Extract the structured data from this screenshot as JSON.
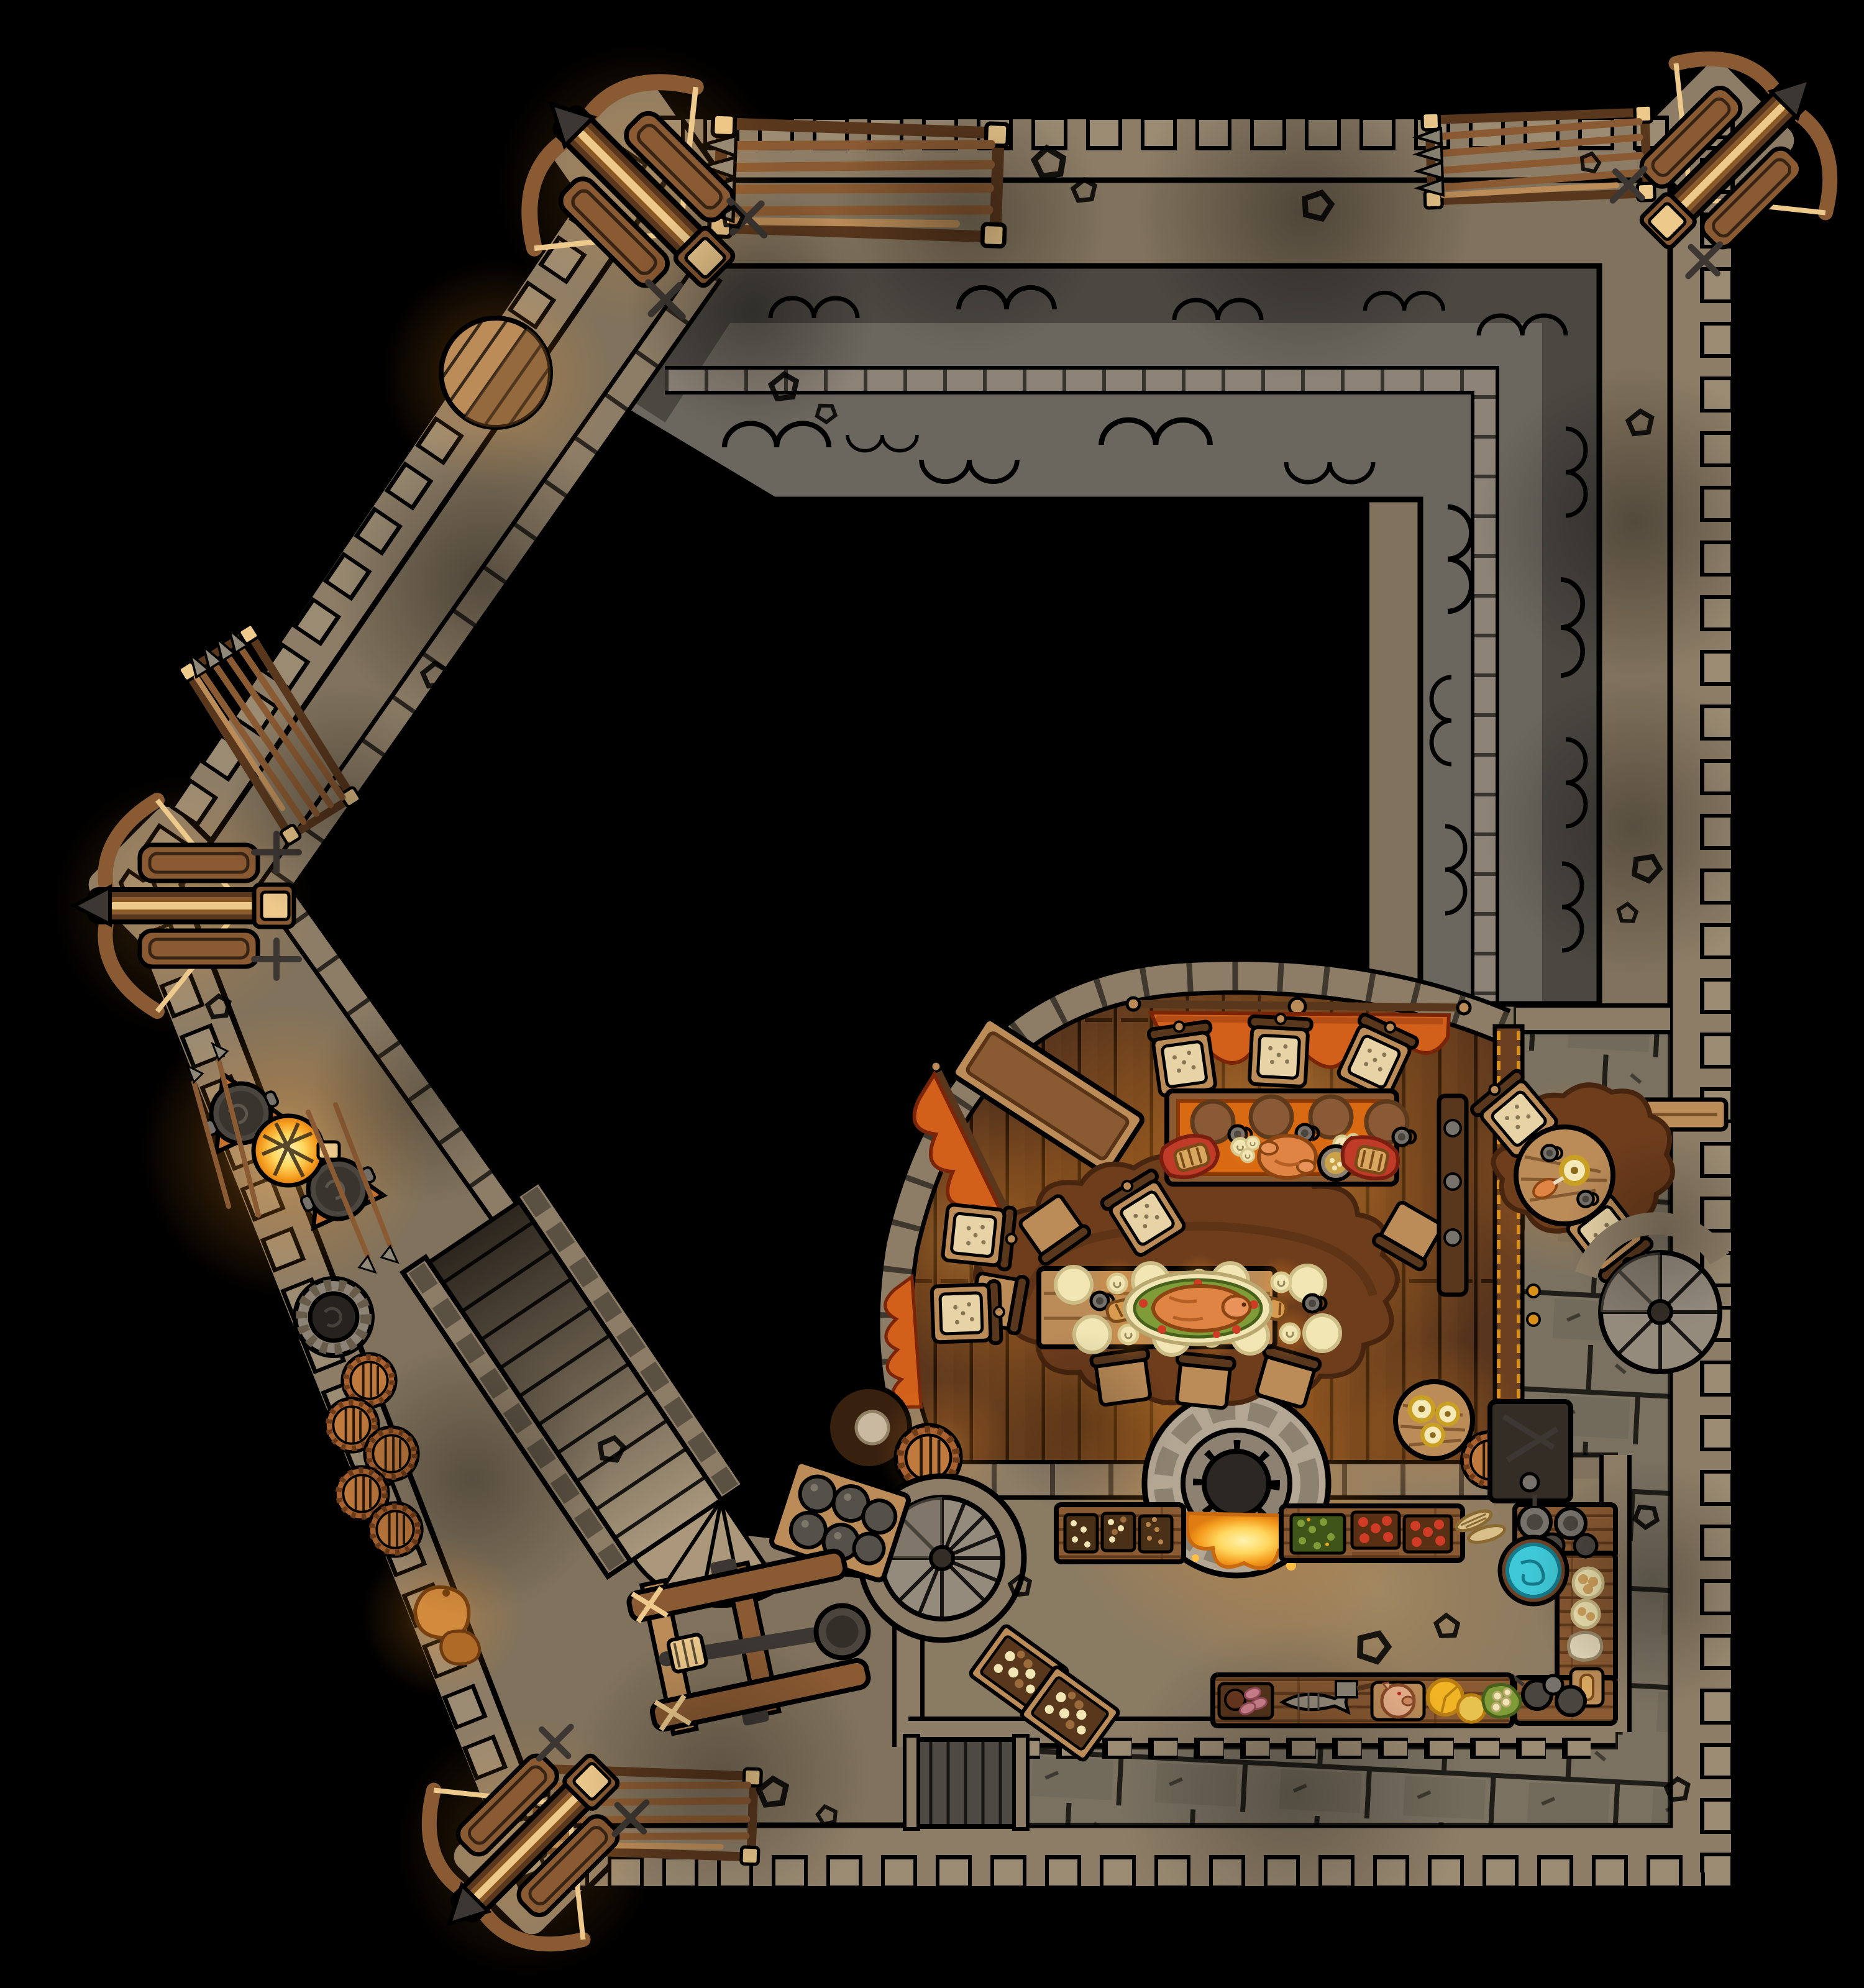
{
  "map": {
    "kind": "top-down fantasy castle battle map",
    "rendering": "hand-drawn, ink outlines, warm torch lighting on black backdrop",
    "grid_visible": false
  },
  "palette": {
    "ink": "#000000",
    "wall_stone": "#8d7d66",
    "wall_stone_dark": "#675b49",
    "merlon": "#9b8b72",
    "walkway": "#80725c",
    "walkway_light": "#ab9779",
    "roof_dark": "#4b4842",
    "roof_light": "#6c675e",
    "ridge_stone": "#8c8276",
    "flagstone": "#7a7161",
    "flagstone_dark": "#5b5344",
    "wood_floor": "#52311b",
    "wood_floor_light": "#6e4524",
    "wood": "#8a5a32",
    "wood_light": "#bb8c58",
    "wood_dark": "#59371d",
    "cloth_orange": "#d96a12",
    "banner_orange": "#d2601a",
    "banner_edge": "#7a2508",
    "glow_orange": "#ff9624",
    "fire_core": "#fff3b0",
    "fire_mid": "#ffd75e",
    "fire_deep": "#f59d1f",
    "plate_cream": "#f2e7b4",
    "plate_brown": "#8a5a36",
    "roast": "#e08443",
    "greens": "#7f9c38",
    "greens_dark": "#3f5418",
    "tomato_red": "#cf3b24",
    "cheese_yellow": "#f0b425",
    "ham_pink": "#d98a96",
    "basin_cyan": "#3fc9d8",
    "basin_edge": "#157a8a",
    "pot_gray": "#76716a",
    "pot_dark": "#4a453f",
    "metal_dark": "#3c3732",
    "fur": "#6e3d1c",
    "fur_dark": "#47250e",
    "rope_tan": "#edc98c",
    "stone_stair": "#948b7d",
    "stone_stair_dark": "#6f675b",
    "cushion": "#e8d3a6",
    "stone_tip": "#8f8878",
    "gold_trim": "#d89018",
    "sack_orange": "#d28a3c"
  },
  "rooms": [
    {
      "name": "north and east wall walk",
      "floor": "packed earth, tan, rubble scattered"
    },
    {
      "name": "northwest and southwest wall walk",
      "floor": "packed earth, tan"
    },
    {
      "name": "inner keep roof",
      "floor": "grey slate with scalloped shingle arcs and stone ridge parapet"
    },
    {
      "name": "keep interior",
      "floor": "unrevealed black"
    },
    {
      "name": "great hall",
      "floor": "dark wood planks, curved west wall, warm candle light"
    },
    {
      "name": "kitchen",
      "floor": "packed earth, tan"
    },
    {
      "name": "east gallery",
      "floor": "grey flagstones"
    },
    {
      "name": "south gallery",
      "floor": "grey flagstones"
    },
    {
      "name": "southwest courtyard",
      "floor": "packed earth"
    }
  ],
  "armaments": {
    "ballistas": [
      {
        "location": "northwest corner tower",
        "facing": "northwest"
      },
      {
        "location": "northeast corner tower",
        "facing": "northeast"
      },
      {
        "location": "west point tower",
        "facing": "west"
      },
      {
        "location": "southwest corner tower",
        "facing": "southwest"
      }
    ],
    "spear_racks": [
      {
        "location": "north wall walk, west end"
      },
      {
        "location": "north wall walk, east end"
      },
      {
        "location": "northwest wall walk"
      },
      {
        "location": "south wall walk"
      }
    ],
    "catapult": {
      "location": "southwest courtyard",
      "state": "stowed, spoon arm mounted"
    },
    "cannonball_crate": {
      "location": "west of kitchen stair tower",
      "balls": 6
    },
    "defense_cauldrons": {
      "count": 2,
      "note": "dark cauldrons on orange braziers beside a lit round fire grate"
    }
  },
  "great_hall": {
    "head_table": {
      "cloth": "orange",
      "items": [
        "4 brown plates",
        "roast fowl",
        "2 bread bundles in red cloth",
        "2 candle clusters",
        "bowl of stew",
        "mugs"
      ]
    },
    "banquet_table": {
      "items": [
        "roast pig on green garnish platter",
        "8 cream plates",
        "6 candles",
        "mugs",
        "2 bread loaves"
      ],
      "rug": "large brown fur rug"
    },
    "chairs": "cushioned chairs with studded tan cushions",
    "banners": "orange scalloped banners hung from wooden rods along the curved wall",
    "sideboard": "long wooden sideboard along northwest curve",
    "corner_furniture": [
      "candle table with 3 candles",
      "dark round table with plate",
      "wooden barrel",
      "vertical serving board with pewter plates"
    ],
    "hearth": "double-sided round stone oven in the kitchen wall, fire lit on both sides"
  },
  "kitchen": {
    "north_counters": [
      "trays of garlic and mushrooms",
      "tray of chopped nuts",
      "tray of greens",
      "two trays of red tomatoes",
      "wheat sheaves"
    ],
    "east_counter": [
      "grey pots and pans",
      "turquoise wash basin",
      "plates of buns",
      "flour sack",
      "cutting board with bread"
    ],
    "south_counter": [
      "ham slices",
      "fish with cleaver",
      "pig head",
      "2 cheese wheels",
      "lettuce and eggs",
      "pans and kettle"
    ],
    "storage": [
      "2 crates of mushrooms",
      "barrel",
      "dark round table"
    ]
  },
  "east_gallery": {
    "furniture": [
      "wall bench",
      "round table on fur rug with candle, mugs and turkey leg",
      "2 cushioned chairs",
      "dark tool rack"
    ],
    "partition": "wood panel wall with gold trim and two candle sconces"
  },
  "west_features": [
    "stone well",
    "cluster of 5 wooden barrels",
    "wide stone staircase with fan landing",
    "round wooden platform",
    "leaning spears",
    "grain sacks"
  ],
  "stairs": {
    "spiral_staircases": [
      {
        "location": "kitchen west tower"
      },
      {
        "location": "east gallery"
      }
    ],
    "straight_staircase": {
      "location": "west wall, wall walk to courtyard",
      "landing": "fan shaped"
    }
  },
  "south_gate": "grey plank double door at west end of south gallery",
  "scatter": "outlined rubble stones along corridors and floors"
}
